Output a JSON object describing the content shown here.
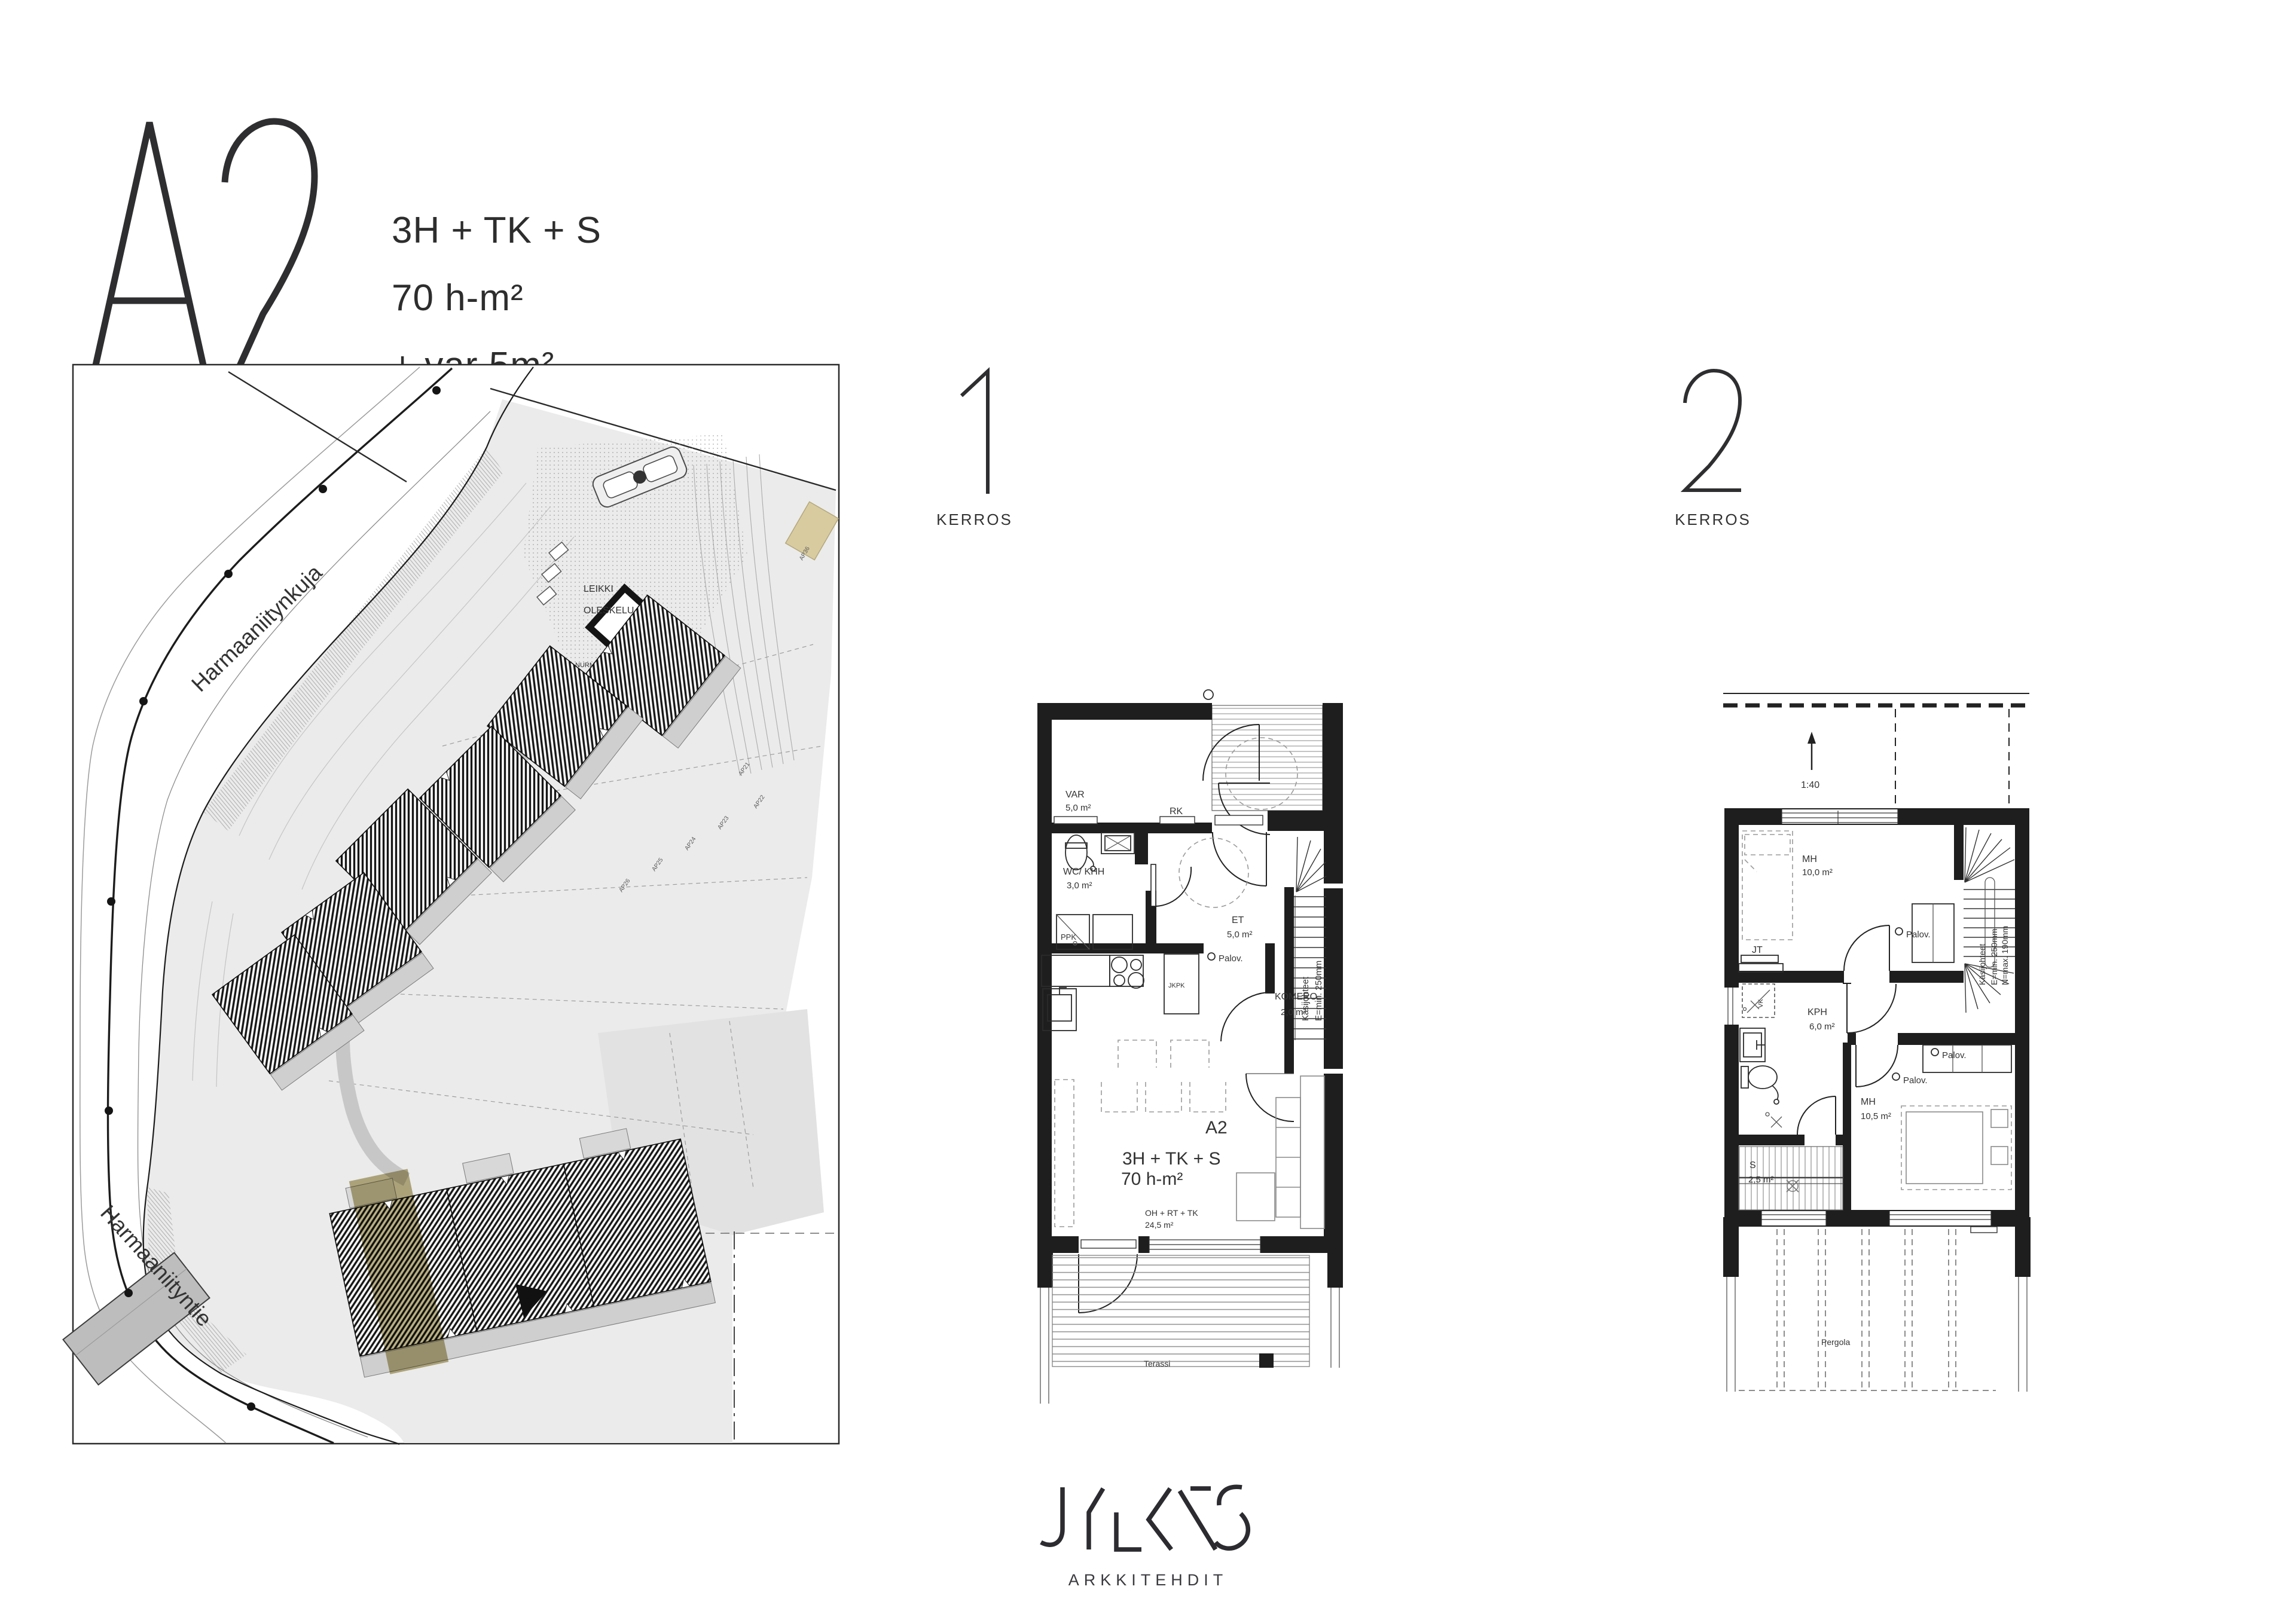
{
  "header": {
    "unit_id": "A2",
    "config": "3H + TK + S",
    "area": "70 h-m²",
    "extra": "+ var 5m²"
  },
  "site_plan": {
    "street_upper": "Harmaaniitynkuja",
    "street_lower": "Harmaaniityntie",
    "play_label_1": "LEIKKI",
    "play_label_2": "OLESKELU",
    "lawn_label": "NURMI",
    "parking_labels": [
      "AP21",
      "AP22",
      "AP23",
      "AP24",
      "AP25",
      "AP26",
      "AP36"
    ],
    "highlight_color": "#ada169"
  },
  "floor1": {
    "number": "1",
    "floor_label": "KERROS",
    "rooms": {
      "var_name": "VAR",
      "var_area": "5,0 m²",
      "rk": "RK",
      "wc_name": "WC/ KHH",
      "wc_area": "3,0 m²",
      "ppk": "PPK",
      "jkpk": "JKPK",
      "et_name": "ET",
      "et_area": "5,0 m²",
      "palov": "Palov.",
      "komero_name": "KOMERO",
      "komero_area": "2,0 m²",
      "stair_note_1": "Käsijohteet",
      "stair_note_2": "E=min. 250mm",
      "unit_id": "A2",
      "unit_config": "3H + TK + S",
      "unit_area": "70 h-m²",
      "living_name": "OH + RT + TK",
      "living_area": "24,5 m²",
      "terrace": "Terassi"
    }
  },
  "floor2": {
    "number": "2",
    "floor_label": "KERROS",
    "scale": "1:40",
    "rooms": {
      "mh1_name": "MH",
      "mh1_area": "10,0 m²",
      "jt": "JT",
      "vk": "VK",
      "palov": "Palov.",
      "stair_note_1": "Käsijohteet",
      "stair_note_2": "E=min. 250mm",
      "stair_note_3": "N=max. 190mm",
      "kph_name": "KPH",
      "kph_area": "6,0 m²",
      "s_name": "S",
      "s_area": "2,5 m²",
      "mh2_name": "MH",
      "mh2_area": "10,5 m²",
      "pergola": "Pergola"
    }
  },
  "footer": {
    "brand": "JYLKÄS",
    "brand_sub": "ARKKITEHDIT"
  }
}
